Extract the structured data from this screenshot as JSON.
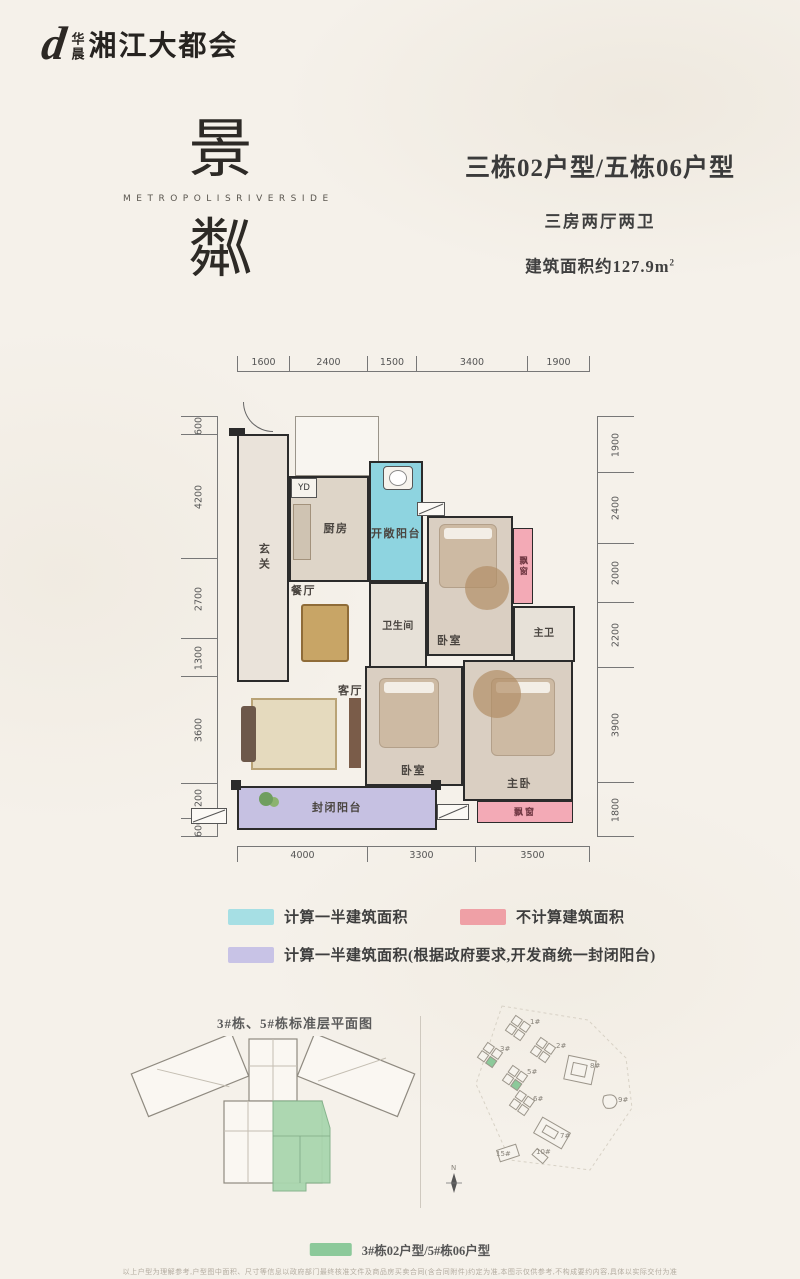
{
  "brand": {
    "logo_mark": "d",
    "logo_cn_small": "华晨",
    "logo_cn_large": "湘江大都会",
    "hero_char_top": "景",
    "hero_en": "METROPOLISRIVERSIDE",
    "hero_char_bottom": "粼"
  },
  "unit_info": {
    "title": "三栋02户型/五栋06户型",
    "rooms": "三房两厅两卫",
    "area": "建筑面积约127.9m",
    "area_sup": "2"
  },
  "floor_plan": {
    "labels": {
      "hallway": "玄关",
      "kitchen": "厨房",
      "flue": "YD",
      "open_balcony": "开敞阳台",
      "bathroom": "卫生间",
      "dining": "餐厅",
      "bedroom_top": "卧室",
      "bay_window": "飘窗",
      "master_bath": "主卫",
      "living": "客厅",
      "bedroom_bottom": "卧室",
      "master_bedroom": "主卧",
      "enclosed_balcony": "封闭阳台",
      "bay_window_bottom": "飘窗"
    },
    "dims": {
      "top": [
        "1600",
        "2400",
        "1500",
        "3400",
        "1900"
      ],
      "bottom": [
        "4000",
        "3300",
        "3500"
      ],
      "left": [
        "600",
        "4200",
        "2700",
        "1300",
        "3600",
        "1200",
        "600"
      ],
      "right": [
        "1900",
        "2400",
        "2000",
        "2200",
        "3900",
        "1800"
      ]
    }
  },
  "legend": {
    "items": [
      {
        "label": "计算一半建筑面积",
        "color": "#a6dfe4"
      },
      {
        "label": "不计算建筑面积",
        "color": "#efa0a6"
      },
      {
        "label": "计算一半建筑面积(根据政府要求,开发商统一封闭阳台)",
        "color": "#c8c3e6"
      }
    ]
  },
  "bottom": {
    "left_title": "3#栋、5#栋标准层平面图",
    "site_buildings": [
      "1#",
      "2#",
      "3#",
      "5#",
      "8#",
      "6#",
      "9#",
      "7#",
      "15#",
      "10#"
    ],
    "compass_label": "N",
    "unit_legend": {
      "label": "3#栋02户型/5#栋06户型",
      "color": "#8cc99a"
    },
    "disclaimer": "以上户型为理解参考,户型图中面积、尺寸等信息以政府部门最终核准文件及商品房买卖合同(含合同附件)约定为准,本图示仅供参考,不构成要约内容,具体以实际交付为准"
  },
  "colors": {
    "open_balcony": "#8ed4e0",
    "bay_window": "#f3aab6",
    "enclosed_balcony": "#c6c1e2",
    "highlight_green": "#8cc99a",
    "wall": "#2b2b2b",
    "background": "#f5f1ea"
  }
}
